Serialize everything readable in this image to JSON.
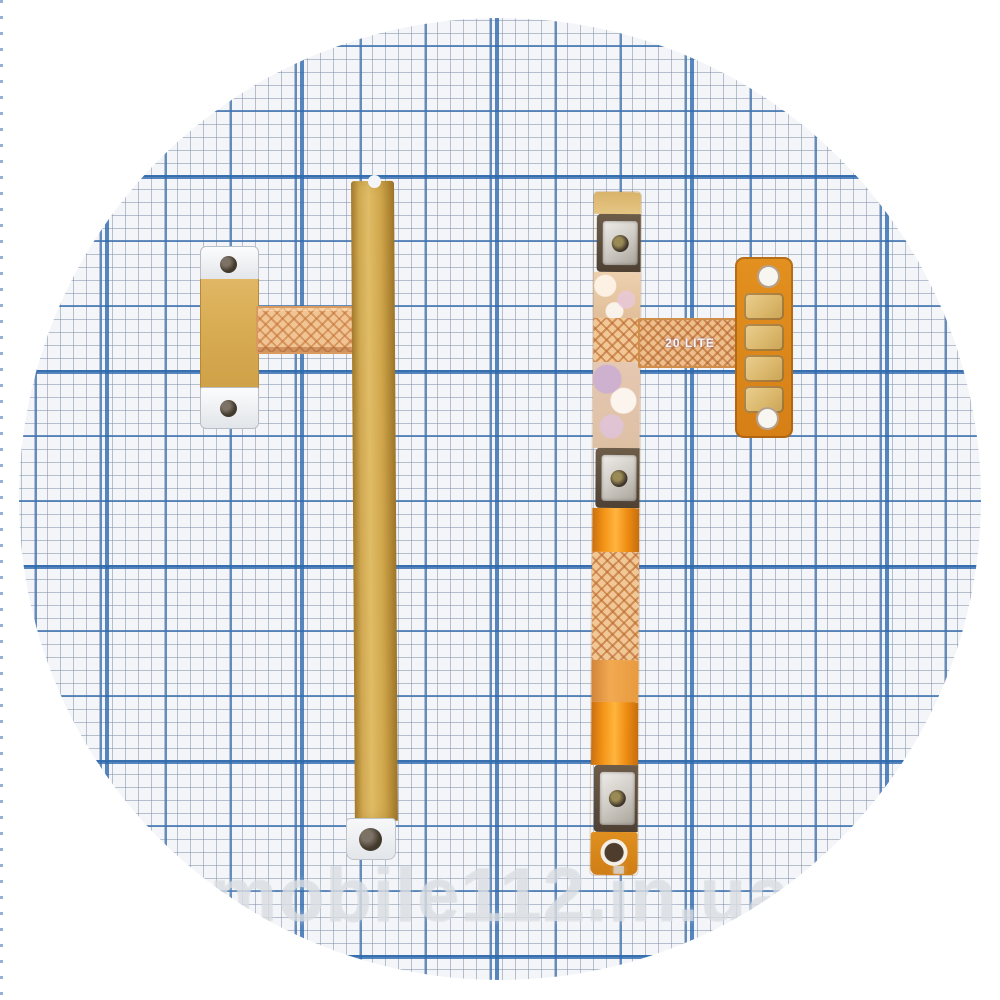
{
  "photo": {
    "watermark": {
      "text": "mobile112.in.ua",
      "color": "#ffffff"
    },
    "paper": {
      "pattern": "blue millimeter graph paper, circular crop",
      "bg_color": "#f3f5f8",
      "fine_line_color": "#8092aa",
      "medium_line_color": "#3e73af",
      "major_line_color": "#2d69ad"
    },
    "left_flex": {
      "name": "gold side-button flex cable with mounting bracket",
      "gold_color": "#d7ab52",
      "copper_ribbon_color": "#f0c493",
      "hole_count": 3
    },
    "right_flex": {
      "name": "orange power/volume flex cable with tactile switches and contact pad",
      "marking": "20 LITE",
      "orange_color": "#ee8c16",
      "switch_count": 3,
      "contact_pad_count": 4
    }
  }
}
